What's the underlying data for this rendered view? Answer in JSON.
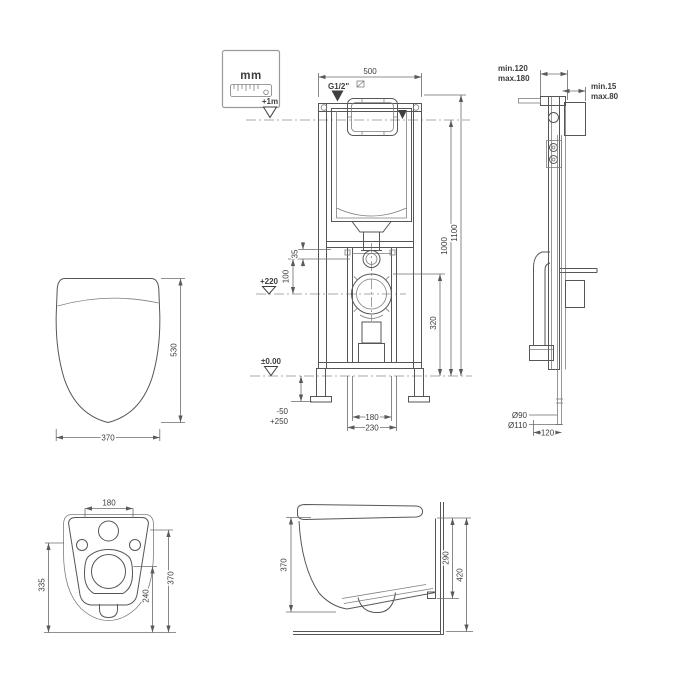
{
  "drawing": {
    "background": "#ffffff",
    "line_color": "#565656",
    "text_color": "#3d3d3d",
    "unit_badge": {
      "label": "mm"
    },
    "frame_front": {
      "width": "500",
      "supply": "G1/2\"",
      "level_flush_plate": "+1m",
      "height_total": "1100",
      "height_to_plate": "1000",
      "outlet_height": "320",
      "inlet_offset": "35",
      "inlet_to_outlet": "100",
      "outlet_level": "+220",
      "floor_level": "±0.00",
      "foot_adjust_down": "-50",
      "foot_adjust_up": "+250",
      "bolt_spacing": "180",
      "bracket_width": "230"
    },
    "frame_side": {
      "depth_min": "min.120",
      "depth_max": "max.180",
      "finish_min": "min.15",
      "finish_max": "max.80",
      "outlet_pipe_d": "Ø90",
      "outlet_sleeve_d": "Ø110",
      "outlet_offset": "120"
    },
    "seat_top": {
      "depth": "530",
      "width": "370"
    },
    "pan_back": {
      "hole_spacing": "180",
      "height_left": "335",
      "height_right": "370",
      "outlet_center": "240"
    },
    "pan_side": {
      "front_height": "370",
      "rear_height": "290",
      "total_height": "420"
    }
  }
}
